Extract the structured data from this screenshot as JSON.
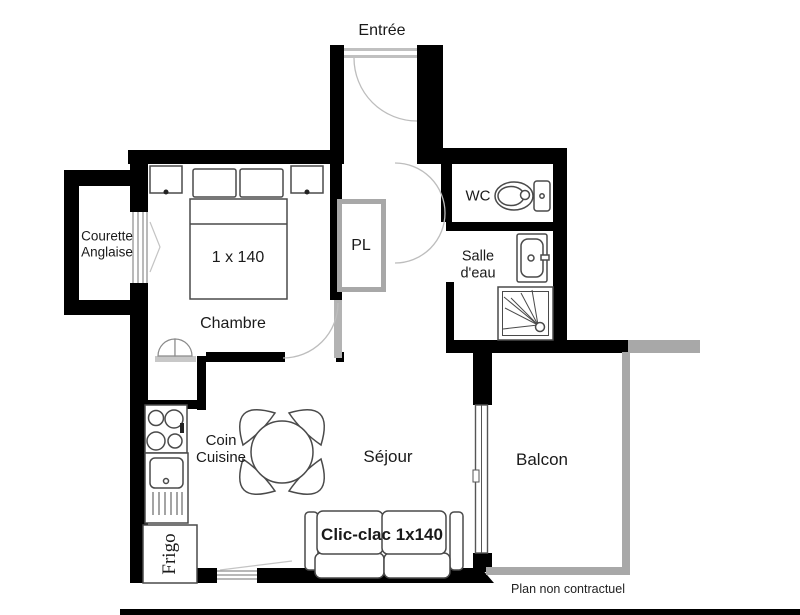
{
  "labels": {
    "entree": "Entrée",
    "courette_line1": "Courette",
    "courette_line2": "Anglaise",
    "bed": "1 x 140",
    "chambre": "Chambre",
    "pl": "PL",
    "wc": "WC",
    "salle_eau_line1": "Salle",
    "salle_eau_line2": "d'eau",
    "coin_line1": "Coin",
    "coin_line2": "Cuisine",
    "sejour": "Séjour",
    "clic_clac": "Clic-clac 1x140",
    "frigo": "Frigo",
    "balcon": "Balcon",
    "disclaimer": "Plan non contractuel"
  },
  "colors": {
    "wall": "#000000",
    "light_structure": "#a8a8a8",
    "furniture_outline": "#4a4a4a",
    "door_arc": "#bdbdbd",
    "background": "#ffffff"
  }
}
